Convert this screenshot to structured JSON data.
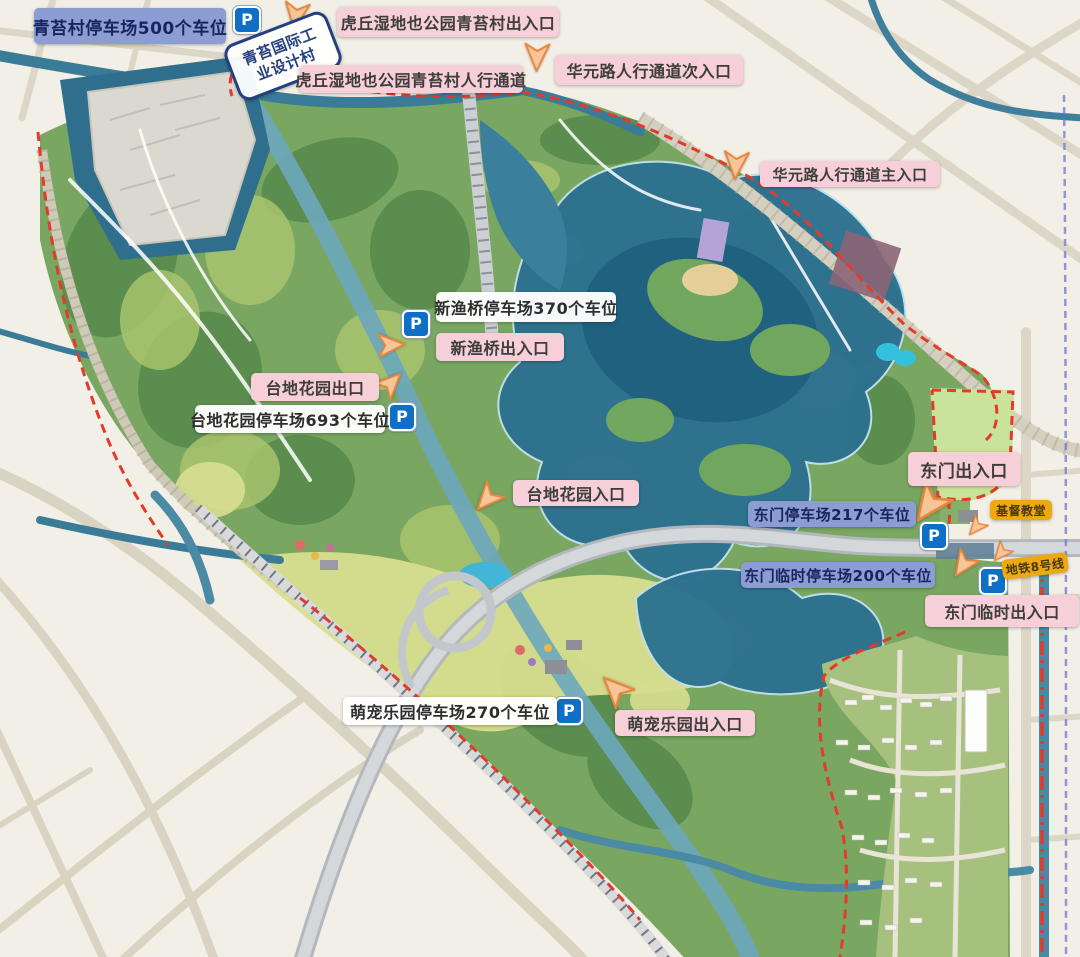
{
  "labels": {
    "qingtai_parking": {
      "text": "青苔村停车场500个车位",
      "style": "blue-parking"
    },
    "qingtai_design_village": {
      "text": "青苔国际工业设计村",
      "style": "white-outline-tilted"
    },
    "qingtai_gate": {
      "text": "虎丘湿地也公园青苔村出入口",
      "style": "pink"
    },
    "qingtai_walkway": {
      "text": "虎丘湿地也公园青苔村人行通道",
      "style": "pink"
    },
    "huayuan_secondary": {
      "text": "华元路人行通道次入口",
      "style": "pink"
    },
    "huayuan_main": {
      "text": "华元路人行通道主入口",
      "style": "pink"
    },
    "xinyuqiao_parking": {
      "text": "新渔桥停车场370个车位",
      "style": "white"
    },
    "xinyuqiao_gate": {
      "text": "新渔桥出入口",
      "style": "pink"
    },
    "terrace_garden_exit": {
      "text": "台地花园出口",
      "style": "pink"
    },
    "terrace_garden_parking": {
      "text": "台地花园停车场693个车位",
      "style": "white"
    },
    "terrace_garden_entrance": {
      "text": "台地花园入口",
      "style": "pink"
    },
    "east_gate": {
      "text": "东门出入口",
      "style": "pink"
    },
    "east_gate_parking": {
      "text": "东门停车场217个车位",
      "style": "blue-parking"
    },
    "church": {
      "text": "基督教堂",
      "style": "gold"
    },
    "east_temp_parking": {
      "text": "东门临时停车场200个车位",
      "style": "blue-parking"
    },
    "metro_line8": {
      "text": "地铁8号线",
      "style": "gold"
    },
    "east_temp_gate": {
      "text": "东门临时出入口",
      "style": "pink"
    },
    "pet_park_parking": {
      "text": "萌宠乐园停车场270个车位",
      "style": "white"
    },
    "pet_park_gate": {
      "text": "萌宠乐园出入口",
      "style": "pink"
    }
  },
  "icons": {
    "parking_badge": "P",
    "entrance_arrow": "orange-directional-arrow"
  },
  "colors": {
    "pink_label_bg": "#f6cfd8",
    "blue_label_bg": "#8c9dd3",
    "white_label_bg": "#ffffff",
    "gold_label_bg": "#eda912",
    "parking_icon_bg": "#0f6fc6",
    "arrow_fill": "#f7c59a",
    "arrow_stroke": "#e8873c",
    "boundary_red": "#e23b2b",
    "water_deep": "#2d7190",
    "water_canal": "#4b8aa5",
    "park_green": "#79a762",
    "field_yellow_green": "#d8dd8e",
    "urban_beige": "#f2efe6"
  }
}
